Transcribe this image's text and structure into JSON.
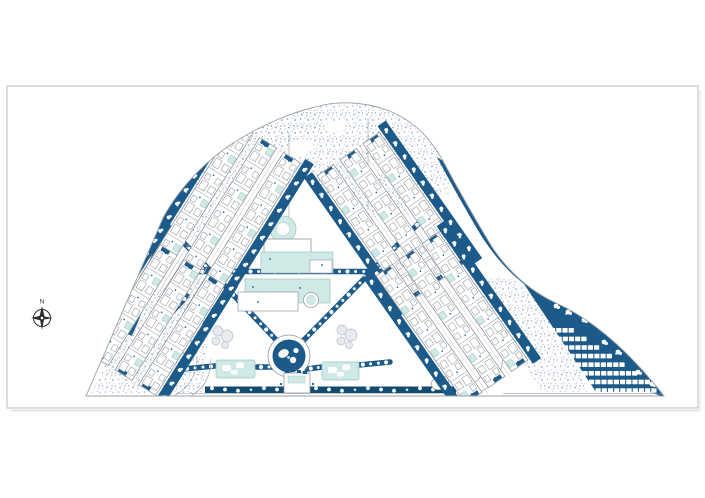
{
  "document": {
    "kind": "architectural site plan",
    "view": "masterplan top view"
  },
  "compass": {
    "label": "N"
  },
  "palette": {
    "navy": "#1c5a8a",
    "navy_deep": "#134a72",
    "teal": "#cfe9e6",
    "teal_dark": "#9fc7c0",
    "stipple": "#9aabbf",
    "line": "#8f969e",
    "frame": "#bcbcbc",
    "playground": "#e7ebef",
    "playground_line": "#b5bfc9"
  },
  "site": {
    "clusters": [
      {
        "id": "north-west",
        "rows": 3,
        "units_per_row": 7
      },
      {
        "id": "south-west",
        "rows": 3,
        "units_per_row": 5
      },
      {
        "id": "north-east",
        "rows": 3,
        "units_per_row": 6
      },
      {
        "id": "south-east",
        "rows": 3,
        "units_per_row": 6
      }
    ],
    "parking": {
      "rows": 8,
      "stalls_first_row": 4,
      "stalls_added_per_row": 1,
      "stalls_max": 10
    },
    "amenities": {
      "pools": 3,
      "spa_circles": 2,
      "fountain_plazas": 1,
      "courts": 2,
      "playgrounds": 2,
      "entrance_gates": 1
    }
  }
}
